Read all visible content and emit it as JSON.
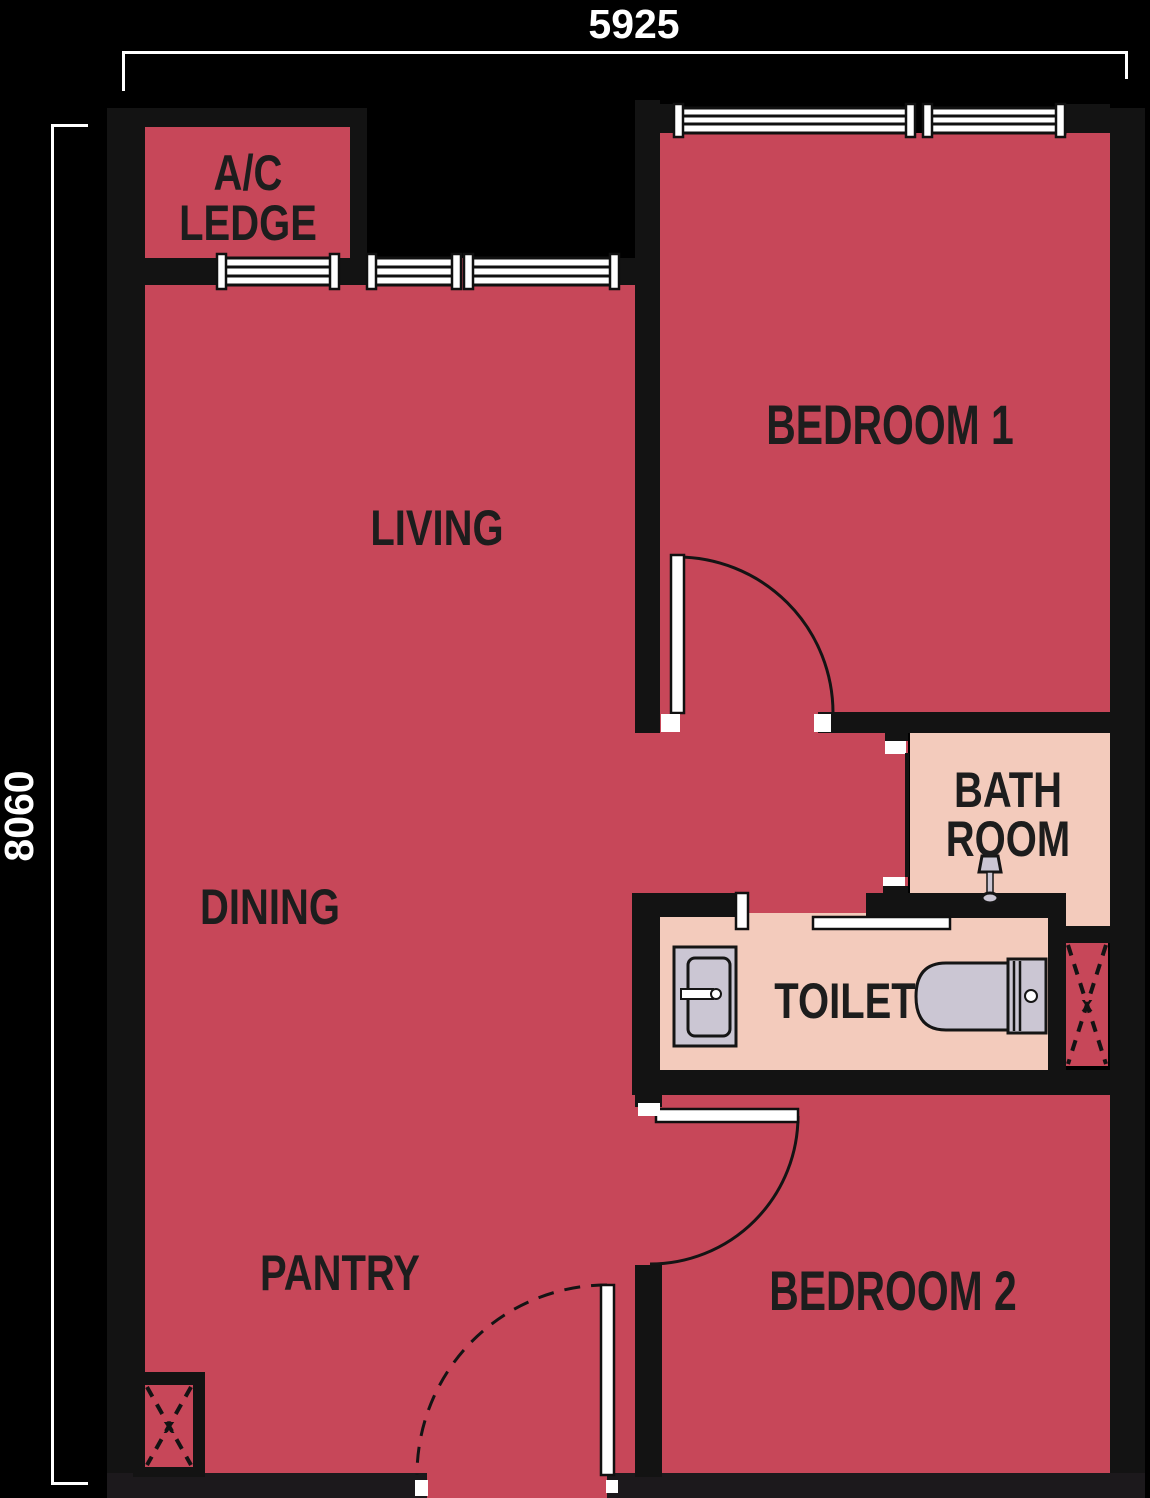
{
  "page_title": "Apartment Unit Floor Plan",
  "dimensions": {
    "top": "5925",
    "left": "8060"
  },
  "rooms": {
    "ac_ledge": {
      "line1": "A/C",
      "line2": "LEDGE"
    },
    "living": {
      "label": "LIVING"
    },
    "dining": {
      "label": "DINING"
    },
    "pantry": {
      "label": "PANTRY"
    },
    "bedroom1": {
      "label": "BEDROOM 1"
    },
    "bathroom": {
      "line1": "BATH",
      "line2": "ROOM"
    },
    "toilet": {
      "label": "TOILET"
    },
    "bedroom2": {
      "label": "BEDROOM 2"
    }
  },
  "ducts": {
    "marker": "x"
  },
  "colors": {
    "background": "#000000",
    "wall": "#131313",
    "room_fill": "#c74759",
    "wet_room_fill": "#f3cbbc",
    "fixture_fill": "#cbc6d3",
    "label_text": "#1d1d1d",
    "dimension": "#ffffff"
  }
}
